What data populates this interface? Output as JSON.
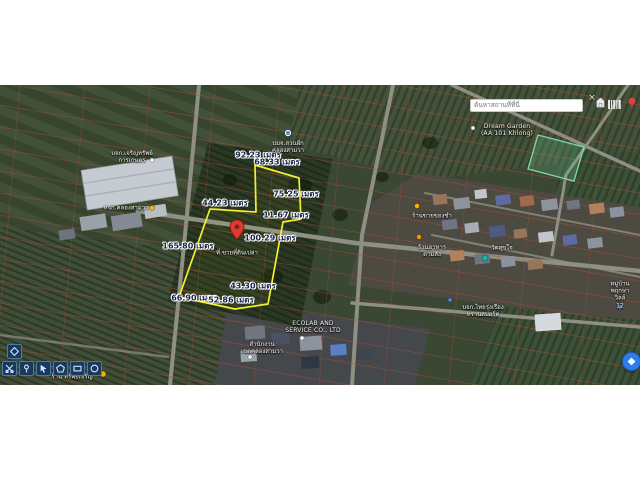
{
  "app": {
    "type": "satellite-map-land-measurement-tool"
  },
  "search": {
    "placeholder": "ค้นหาสถานที่ที่นี่",
    "close_label": "×",
    "icons": [
      "home-icon",
      "barcode-icon",
      "red-pin-icon"
    ]
  },
  "measurements": [
    {
      "text": "92.23 เมตร"
    },
    {
      "text": "68.33 เมตร"
    },
    {
      "text": "44.23 เมตร"
    },
    {
      "text": "75.25 เมตร"
    },
    {
      "text": "11.67 เมตร"
    },
    {
      "text": "165.80 เมตร"
    },
    {
      "text": "100.29 เมตร"
    },
    {
      "text": "43.30 เมตร"
    },
    {
      "text": "66.90 เมตร"
    },
    {
      "text": "52.86 เมตร"
    }
  ],
  "pin": {
    "label": "ที่ ขายที่ดินเปล่า"
  },
  "places": [
    {
      "text": "บจก.เจริญทรัพย์\nการเกษตร"
    },
    {
      "text": "หจก.คลองสามวา"
    },
    {
      "text": "บมจ.สวนผัก\nคลองสามวา"
    },
    {
      "text": "Dream Garden\n(AA 101 Khlong)"
    },
    {
      "text": "ร้านขายของชำ"
    },
    {
      "text": "ร้านอาหาร\nตามสั่ง"
    },
    {
      "text": "วัดสุขใจ"
    },
    {
      "text": "ECOLAB AND\nSERVICE CO., LTD"
    },
    {
      "text": "สำนักงาน\nเขตคลองสามวา"
    },
    {
      "text": "ร้าน ทรัพย์เจริญ"
    },
    {
      "text": "บจก.ไทยรุ่งเรือง\nทรานสปอร์ต"
    },
    {
      "text": "หมู่บ้าน\nพฤกษาวิลล์ 12"
    }
  ],
  "toolbar": {
    "buttons": [
      "layers",
      "cut",
      "pin",
      "select",
      "draw-polygon",
      "draw-rectangle",
      "draw-circle"
    ]
  },
  "colors": {
    "polygon": "#f4f02e",
    "main_pin": "#e03a2f",
    "fab_blue": "#2b7de9",
    "boundary_red": "#b8503a"
  }
}
